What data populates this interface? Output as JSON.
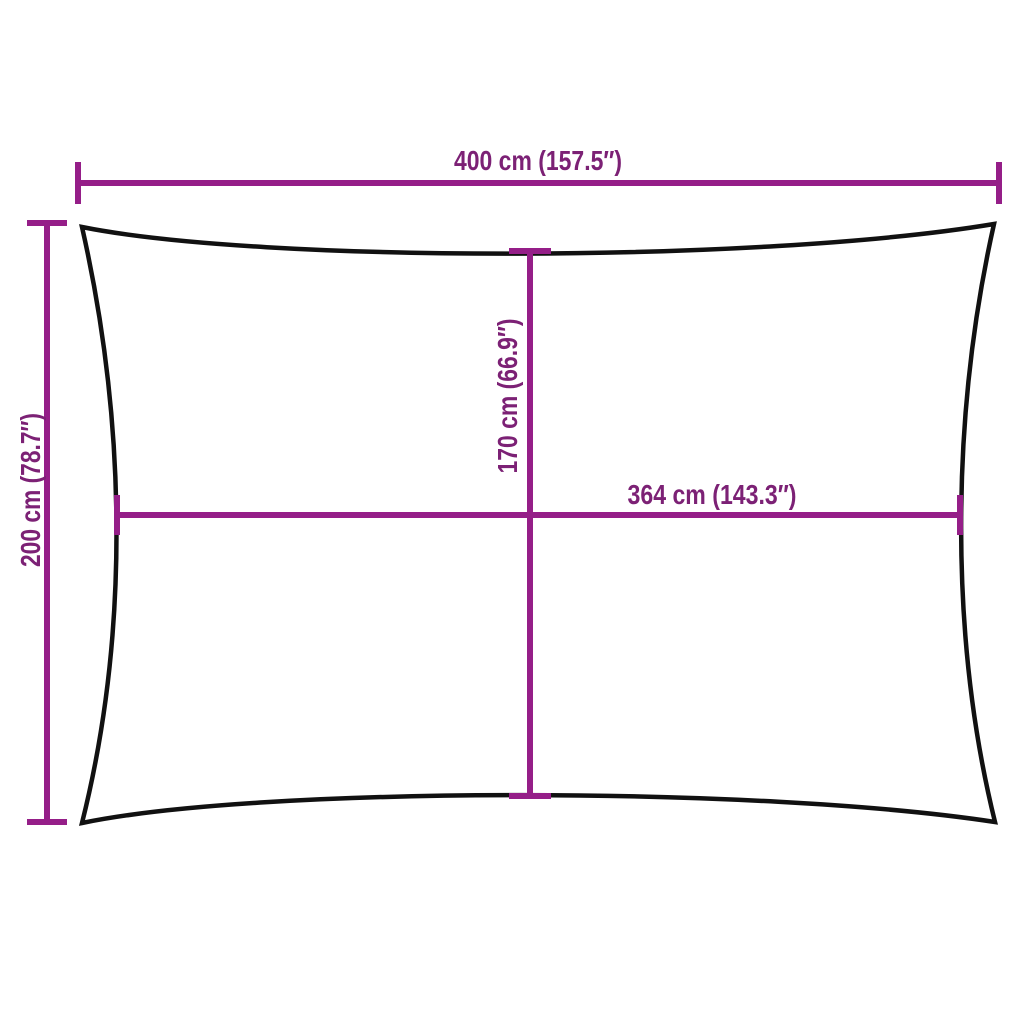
{
  "diagram": {
    "type": "product-dimension-diagram",
    "subject": "rectangular shade sail (concave edges), top view",
    "colors": {
      "background": "#ffffff",
      "outline": "#111111",
      "dimension_line": "#951e88",
      "dimension_text": "#7c2175"
    },
    "dimensions": {
      "top_width": {
        "label": "400 cm (157.5″)",
        "value_cm": 400,
        "value_in": 157.5,
        "orientation": "horizontal"
      },
      "left_height": {
        "label": "200 cm (78.7″)",
        "value_cm": 200,
        "value_in": 78.7,
        "orientation": "vertical"
      },
      "center_height": {
        "label": "170 cm (66.9″)",
        "value_cm": 170,
        "value_in": 66.9,
        "orientation": "vertical"
      },
      "center_width": {
        "label": "364 cm (143.3″)",
        "value_cm": 364,
        "value_in": 143.3,
        "orientation": "horizontal"
      }
    }
  }
}
